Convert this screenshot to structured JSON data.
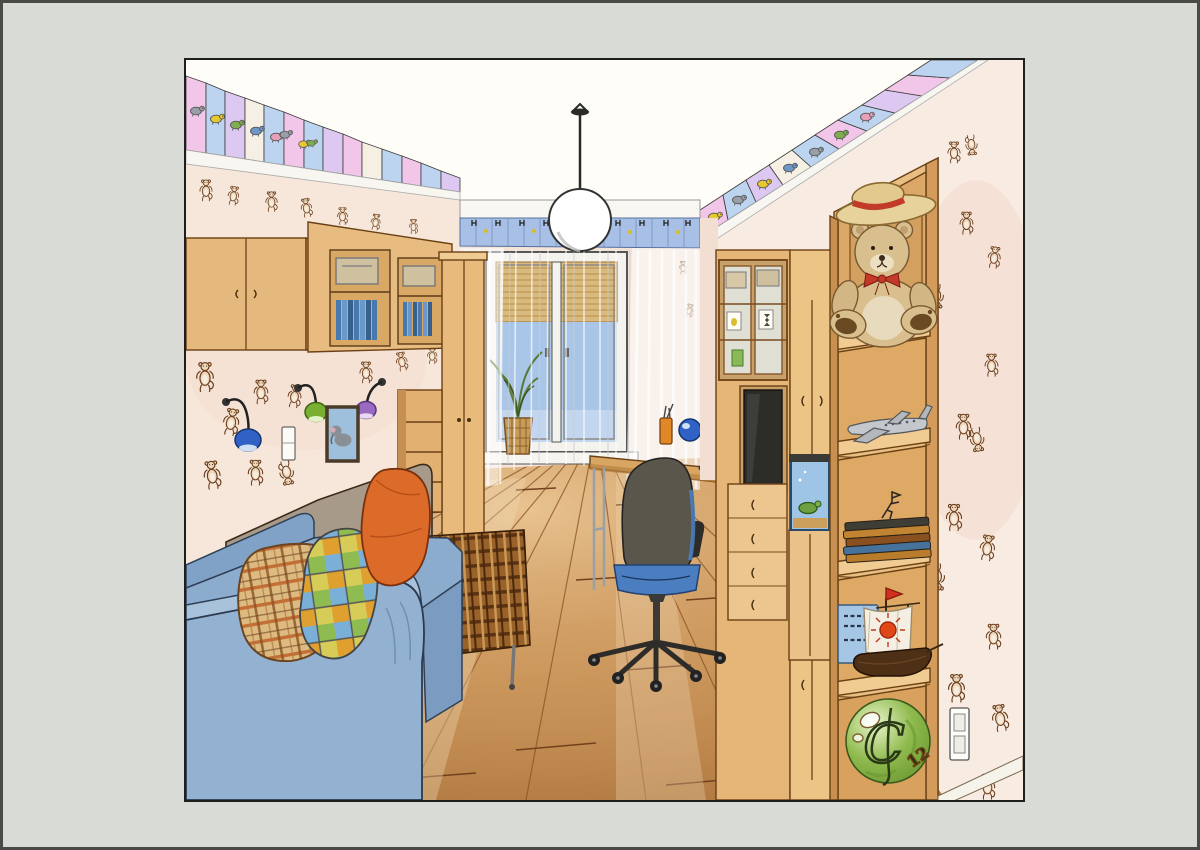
{
  "artwork": {
    "kind": "hand-colored interior design sketch",
    "subject": "children's room in one-point perspective",
    "signature_ball": {
      "monogram": "C",
      "number": "12"
    },
    "book_cover": {
      "color": "blue",
      "text_style": "illegible Cyrillic scribbles"
    },
    "frieze_animals": [
      "elephant",
      "duck",
      "turtle",
      "bird",
      "mouse",
      "chick"
    ],
    "objects": [
      "ceiling frieze with animal tiles",
      "wallpaper with monkey doodles",
      "pendant globe lamp",
      "wall cabinets with open shelves",
      "wall spot lamps (blue, green, purple)",
      "framed elephant picture",
      "light switch",
      "blue sofa with plaid and orange pillows",
      "brown plaid chaise bench",
      "swivel desk chair",
      "desk with drawer pedestal",
      "blue desk lamp",
      "pencil cup",
      "window with bamboo blind and sheer curtains",
      "potted plant on windowsill",
      "wall unit with glass display cabinet",
      "television",
      "aquarium with turtle",
      "teddy bear with straw hat",
      "model airplane",
      "stack of books with horseman figurine",
      "model sailing ship with sun sail",
      "green ball with monogram",
      "power outlet",
      "wooden plank floor"
    ]
  },
  "palette": {
    "mat": "#d9dbd7",
    "paper": "#fffdf8",
    "wallpaper": "#f6e7da",
    "wallpaper_right": "#f8ebe2",
    "wood": "#e9be82",
    "wood_dark": "#6a4015",
    "floor": "#c79258",
    "floor_seam": "#7a4420",
    "sofa_blue": "#93b2d2",
    "sofa_gray": "#a89a88",
    "pillow_orange": "#dc6a28",
    "pillow_tan": "#ddbb80",
    "plaid_brown": "#9a6228",
    "chair_gray": "#5b564c",
    "chair_blue": "#4a7ec0",
    "desk_lamp_blue": "#2f62c4",
    "wall_lamp_blue": "#2f62c4",
    "wall_lamp_green": "#7ab032",
    "wall_lamp_purple": "#9a6ac0",
    "curtain_header": "#a9c0e6",
    "sky": "#a9c6e8",
    "blind": "#d9ba7e",
    "teddy": "#d9bf8e",
    "hat_band_red": "#c23a28",
    "tv_screen": "#2c2c28",
    "aquarium": "#9ec4e6",
    "turtle": "#6fa040",
    "airplane": "#c4c8cc",
    "ship_sun": "#e04818",
    "ball_green": "#8fba4e",
    "frieze_pink": "#f1c6e8",
    "frieze_blue": "#bcd4f0",
    "frieze_lavender": "#dcc8f0",
    "frieze_cream": "#f6f0e4",
    "monkey_brown": "#6b3f1f"
  }
}
